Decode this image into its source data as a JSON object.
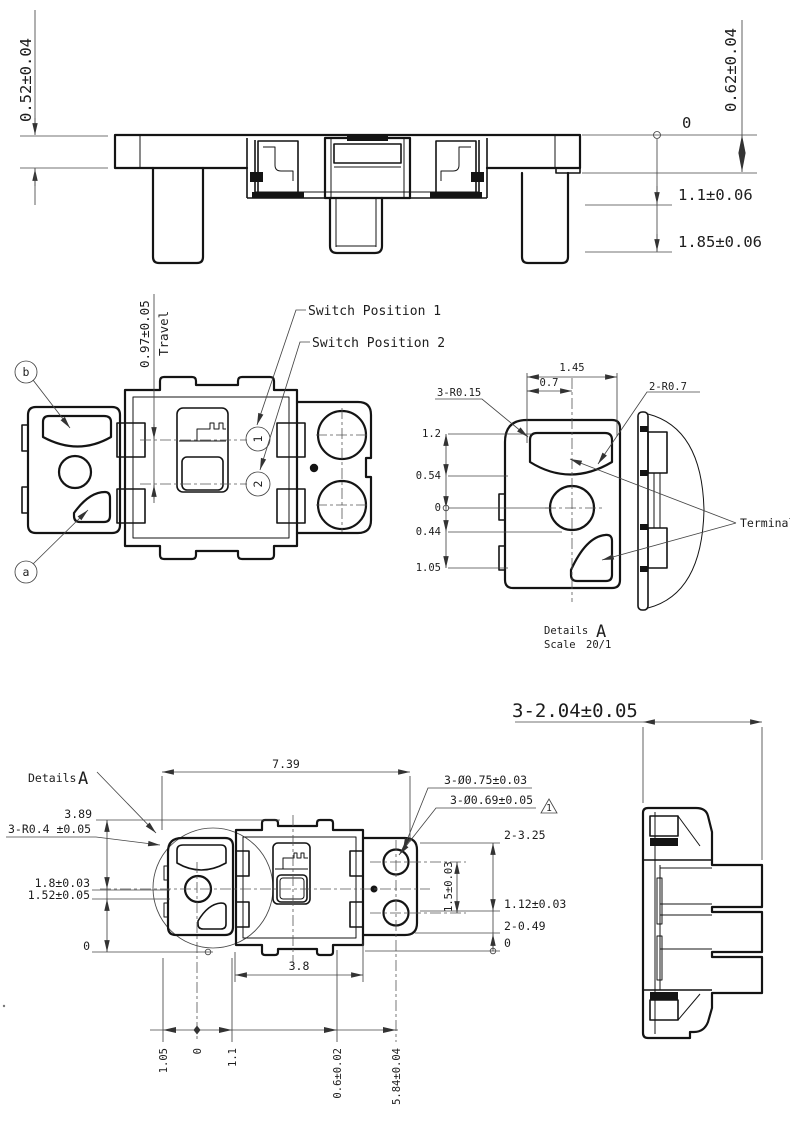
{
  "sheet": {
    "type": "engineering-drawing",
    "background": "#ffffff",
    "line_color": "#141414",
    "dim_color": "#454545"
  },
  "top_view": {
    "dim_height_left": "0.52±0.04",
    "dim_height_right": "0.62±0.04",
    "datum_zero": "0",
    "dim_step1": "1.1±0.06",
    "dim_step2": "1.85±0.06"
  },
  "middle_view": {
    "travel_dim": "0.97±0.05",
    "travel_label": "Travel",
    "switch_position_1": "Switch Position 1",
    "switch_position_2": "Switch Position 2",
    "balloon_1": "1",
    "balloon_2": "2",
    "balloon_a": "a",
    "balloon_b": "b"
  },
  "detail_view": {
    "dim_width": "1.45",
    "dim_half_width": "0.7",
    "radius_note_1": "3-R0.15",
    "radius_note_2": "2-R0.7",
    "dim_y_12": "1.2",
    "dim_y_054": "0.54",
    "dim_y_0": "0",
    "dim_y_044": "0.44",
    "dim_y_105": "1.05",
    "terminals_label": "Terminals",
    "details_word": "Details",
    "details_letter": "A",
    "scale_word": "Scale",
    "scale_value": "20/1"
  },
  "bottom_view": {
    "details_word": "Details",
    "details_letter": "A",
    "dim_total_width": "7.39",
    "hole_note_1": "3-Ø0.75±0.03",
    "hole_note_2": "3-Ø0.69±0.05",
    "flag_number": "1",
    "dim_389": "3.89",
    "radius_note": "3-R0.4 ±0.05",
    "dim_18": "1.8±0.03",
    "dim_152": "1.52±0.05",
    "datum_left": "0",
    "dim_2325": "2-3.25",
    "dim_15": "1.5±0.03",
    "dim_112": "1.12±0.03",
    "dim_2049": "2-0.49",
    "datum_right": "0",
    "dim_38": "3.8",
    "dim_105": "1.05",
    "datum_bottom": "0",
    "dim_11": "1.1",
    "dim_06": "0.6±0.02",
    "dim_584": "5.84±0.04"
  },
  "side_view": {
    "dim_pitch": "3-2.04±0.05"
  }
}
